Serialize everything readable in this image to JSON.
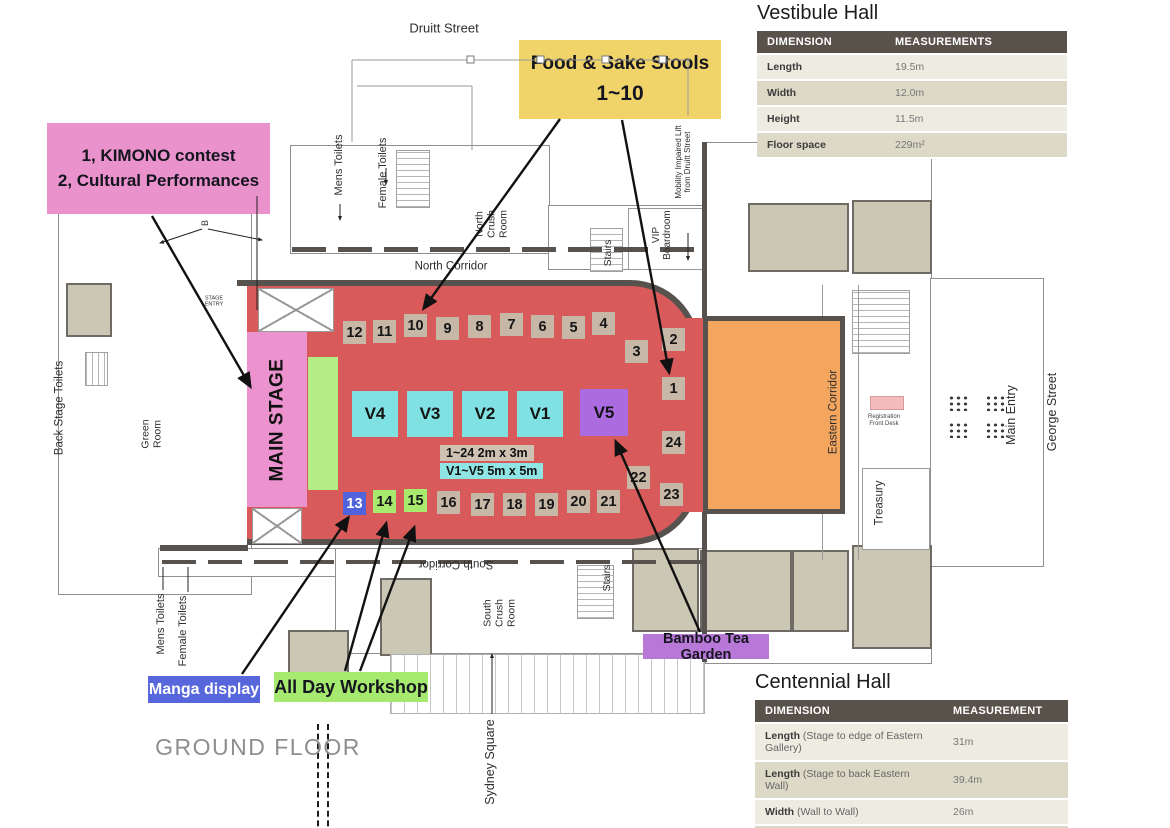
{
  "streets": {
    "druitt": "Druitt Street",
    "george": "George Street",
    "sydney_square": "Sydney Square",
    "ground_floor": "GROUND FLOOR"
  },
  "rooms": {
    "mens_toilets_top": "Mens Toilets",
    "female_toilets_top": "Female Toilets",
    "north_crush_room": "North\nCrush\nRoom",
    "stairs_top": "Stairs",
    "vip_boardroom": "VIP\nBoardroom",
    "mobility_lift": "Mobility Impaired Lift\nfrom Druitt Street",
    "north_corridor": "North Corridor",
    "stage_entry": "STAGE\nENTRY",
    "b_door": "B",
    "back_stage_toilets": "Back Stage Toilets",
    "green_room": "Green\nRoom",
    "eastern_corridor": "Eastern Corridor",
    "registration": "Registration\nFront Desk",
    "main_entry": "Main Entry",
    "treasury": "Treasury",
    "south_corridor": "South Corridor",
    "south_crush_room": "South\nCrush\nRoom",
    "stairs_bottom": "Stairs",
    "mens_toilets_bottom": "Mens Toilets",
    "female_toilets_bottom": "Female Toilets"
  },
  "stage_label": "MAIN STAGE",
  "stools": [
    "1",
    "2",
    "3",
    "4",
    "5",
    "6",
    "7",
    "8",
    "9",
    "10",
    "11",
    "12",
    "13",
    "14",
    "15",
    "16",
    "17",
    "18",
    "19",
    "20",
    "21",
    "22",
    "23",
    "24"
  ],
  "booths": [
    "V4",
    "V3",
    "V2",
    "V1",
    "V5"
  ],
  "legend": {
    "stools_size": "1~24  2m x 3m",
    "booths_size": "V1~V5 5m x 5m"
  },
  "callouts": {
    "kimono": {
      "line1": "1, KIMONO contest",
      "line2": "2, Cultural Performances"
    },
    "food_sake": {
      "line1": "Food & Sake Stools",
      "line2": "1~10"
    },
    "bamboo": {
      "label": "Bamboo Tea Garden"
    },
    "manga": {
      "label": "Manga display"
    },
    "workshop": {
      "label": "All Day Workshop"
    }
  },
  "vestibule_table": {
    "title": "Vestibule Hall",
    "headers": [
      "DIMENSION",
      "MEASUREMENTS"
    ],
    "rows": [
      {
        "name": "Length",
        "value": "19.5m"
      },
      {
        "name": "Width",
        "value": "12.0m"
      },
      {
        "name": "Height",
        "value": "11.5m"
      },
      {
        "name": "Floor space",
        "value": "229m²"
      }
    ]
  },
  "centennial_table": {
    "title": "Centennial Hall",
    "headers": [
      "DIMENSION",
      "MEASUREMENT"
    ],
    "rows": [
      {
        "name": "Length",
        "detail": "(Stage to edge of Eastern Gallery)",
        "value": "31m"
      },
      {
        "name": "Length",
        "detail": "(Stage to back Eastern Wall)",
        "value": "39.4m"
      },
      {
        "name": "Width",
        "detail": "(Wall to Wall)",
        "value": "26m"
      },
      {
        "name": "Height",
        "detail": "(floor to ceiling)",
        "value": "20m"
      }
    ]
  },
  "colors": {
    "hall_red": "#d85a5a",
    "vestibule_orange": "#f4a55e",
    "stage_pink": "#ec92ce",
    "workshop_green": "#a8ea6e",
    "booth_cyan": "#7fe1e1",
    "booth_purple": "#aa6ce0",
    "stool_tan": "#c7b7a7",
    "manga_blue": "#5062dc",
    "food_yellow": "#f0d469",
    "bamboo_purple": "#b778d8",
    "table_header_brown": "#59524b",
    "table_row_light": "#eeebe0",
    "table_row_dark": "#ddd9c7",
    "wall_gray": "#57524e"
  }
}
